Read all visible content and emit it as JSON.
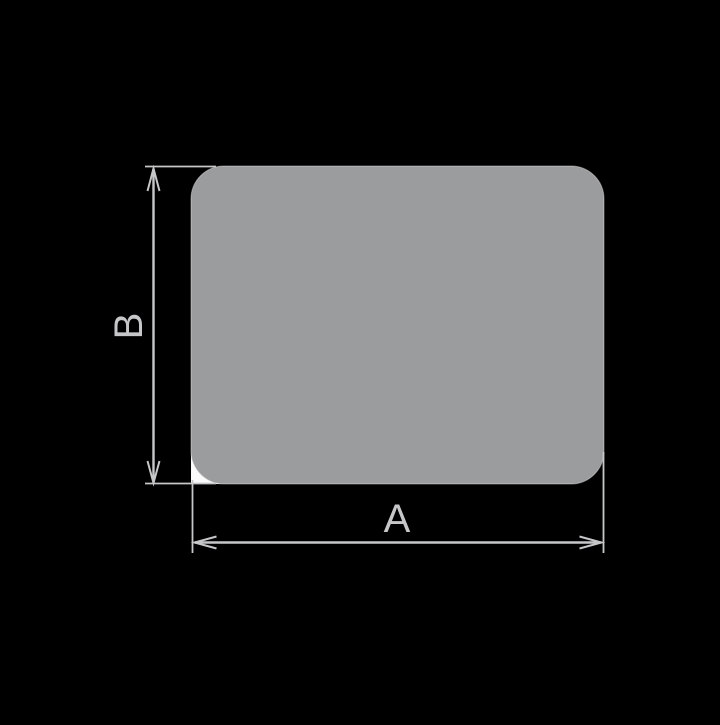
{
  "window": {
    "background": "#000000"
  },
  "diagram": {
    "kind": "rounded-rectangle profile cross-section with dimension arrows",
    "profile": {
      "fill": "#9b9c9e",
      "edge_highlight": "rgba(255,255,255,0.4)",
      "corner_notch_fill": "#fafafa"
    },
    "dimension_color": "#c6c7c9",
    "dimensions": [
      {
        "id": "width",
        "label": "A",
        "orientation": "horizontal",
        "position": "bottom"
      },
      {
        "id": "height",
        "label": "B",
        "orientation": "vertical",
        "position": "left"
      }
    ]
  }
}
